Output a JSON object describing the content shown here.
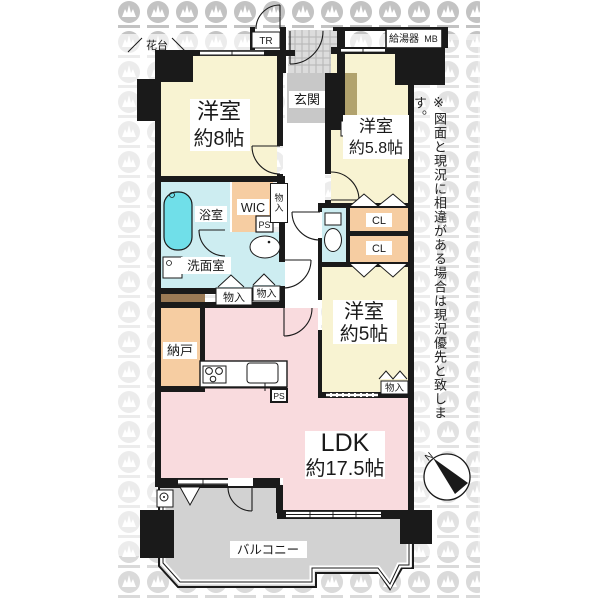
{
  "disclaimer": "※図面と現況に相違がある場合は現況優先と致します。",
  "compass": {
    "north_label": "N"
  },
  "exterior": {
    "flower_stand": "花台",
    "trunk_room": "TR",
    "water_heater": "給湯器",
    "meter_box": "MB",
    "balcony": "バルコニー"
  },
  "rooms": {
    "bedroom_8": {
      "name": "洋室",
      "size": "約8帖"
    },
    "bedroom_5_8": {
      "name": "洋室",
      "size": "約5.8帖"
    },
    "bedroom_5": {
      "name": "洋室",
      "size": "約5帖"
    },
    "ldk": {
      "name": "LDK",
      "size": "約17.5帖"
    },
    "entrance": "玄関",
    "bathroom": "浴室",
    "washroom": "洗面室",
    "walk_in_closet": "WIC",
    "storage_room": "納戸"
  },
  "closets": {
    "cl_upper": "CL",
    "cl_lower": "CL",
    "monoire_hall_column": "物入",
    "monoire_hall_left": "物入",
    "monoire_hall_right": "物入",
    "monoire_bedroom5": "物入"
  },
  "utilities": {
    "ps_hall": "PS",
    "ps_kitchen": "PS"
  },
  "colors": {
    "bedroom_cream": "#f8f3d2",
    "ldk_pink": "#f9dbde",
    "storage_peach": "#f6cda2",
    "wet_cyan": "#cdedf1",
    "bathtub_cyan": "#70dfe9",
    "balcony_gray": "#d2d2d2",
    "entrance_gray": "#c8c8c8",
    "tile_gray": "#dcdcdc",
    "tan_strip": "#b1a26d",
    "brown_strip": "#9b7a55",
    "wall_black": "#1a1a1a"
  }
}
